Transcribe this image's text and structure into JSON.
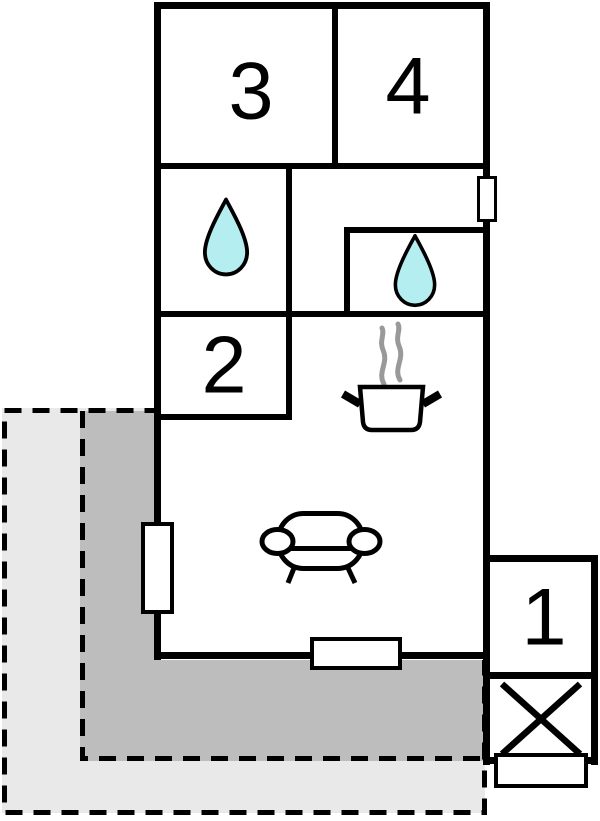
{
  "floorplan": {
    "rooms": [
      {
        "id": "room-1",
        "label": "1"
      },
      {
        "id": "room-2",
        "label": "2"
      },
      {
        "id": "room-3",
        "label": "3"
      },
      {
        "id": "room-4",
        "label": "4"
      }
    ],
    "colors": {
      "wall": "#000000",
      "floor": "#ffffff",
      "water_drop": "#b5eef1",
      "water_drop_outline": "#000000",
      "terrace_dark": "#bdbdbd",
      "terrace_light": "#e9e9e9",
      "steam": "#999999"
    },
    "icons": {
      "bathroom_1": "water-drop-icon",
      "bathroom_2": "water-drop-icon",
      "kitchen": "cooking-pot-icon",
      "living_room": "sofa-icon",
      "entrance_box": "crossed-box-icon",
      "wall_openings": "door-window-marker"
    }
  }
}
